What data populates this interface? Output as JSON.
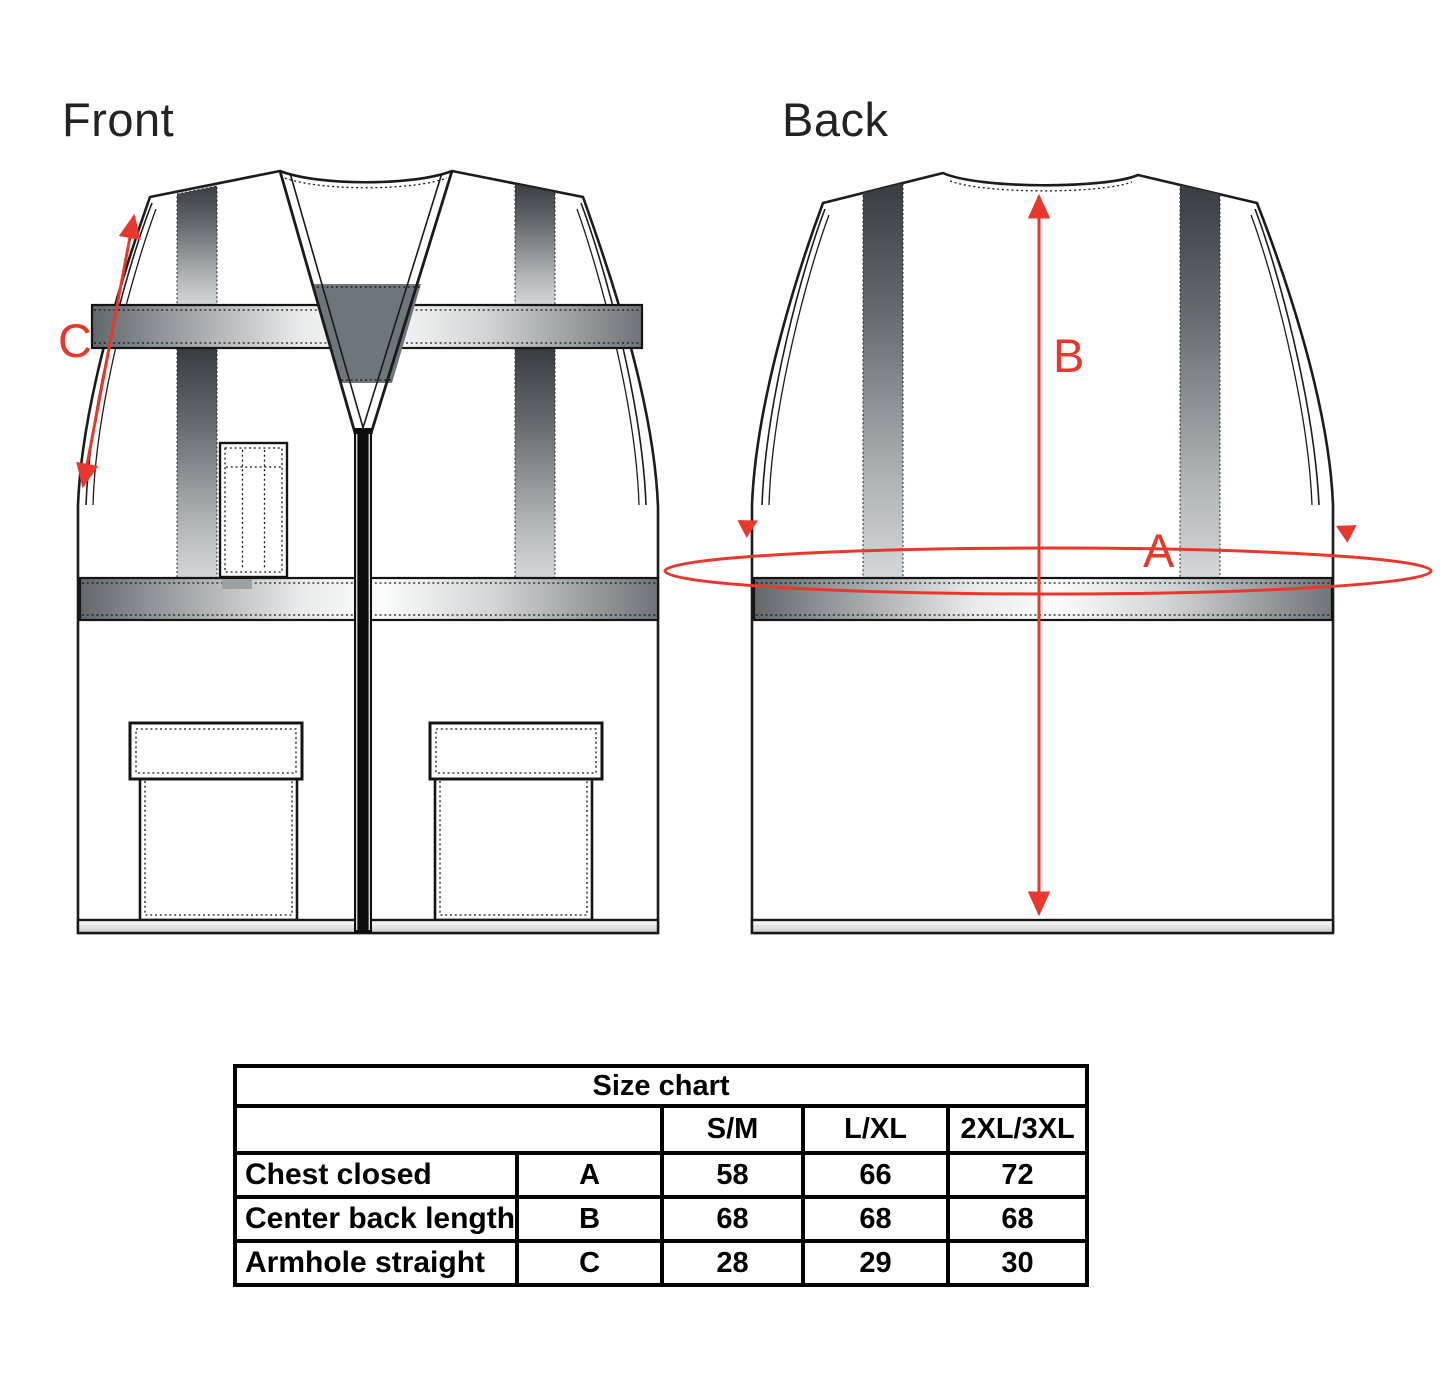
{
  "views": {
    "front_label": "Front",
    "back_label": "Back"
  },
  "measurements": {
    "chest_label": "A",
    "back_length_label": "B",
    "armhole_label": "C"
  },
  "colors": {
    "annotation_red": "#e8382d",
    "outline_black": "#1c1c1c",
    "inner_panel_gray": "#6d767a"
  },
  "size_chart": {
    "title": "Size chart",
    "size_headers": [
      "S/M",
      "L/XL",
      "2XL/3XL"
    ],
    "rows": [
      {
        "label": "Chest closed",
        "letter": "A",
        "values": [
          "58",
          "66",
          "72"
        ]
      },
      {
        "label": "Center back length",
        "letter": "B",
        "values": [
          "68",
          "68",
          "68"
        ]
      },
      {
        "label": "Armhole straight",
        "letter": "C",
        "values": [
          "28",
          "29",
          "30"
        ]
      }
    ]
  }
}
